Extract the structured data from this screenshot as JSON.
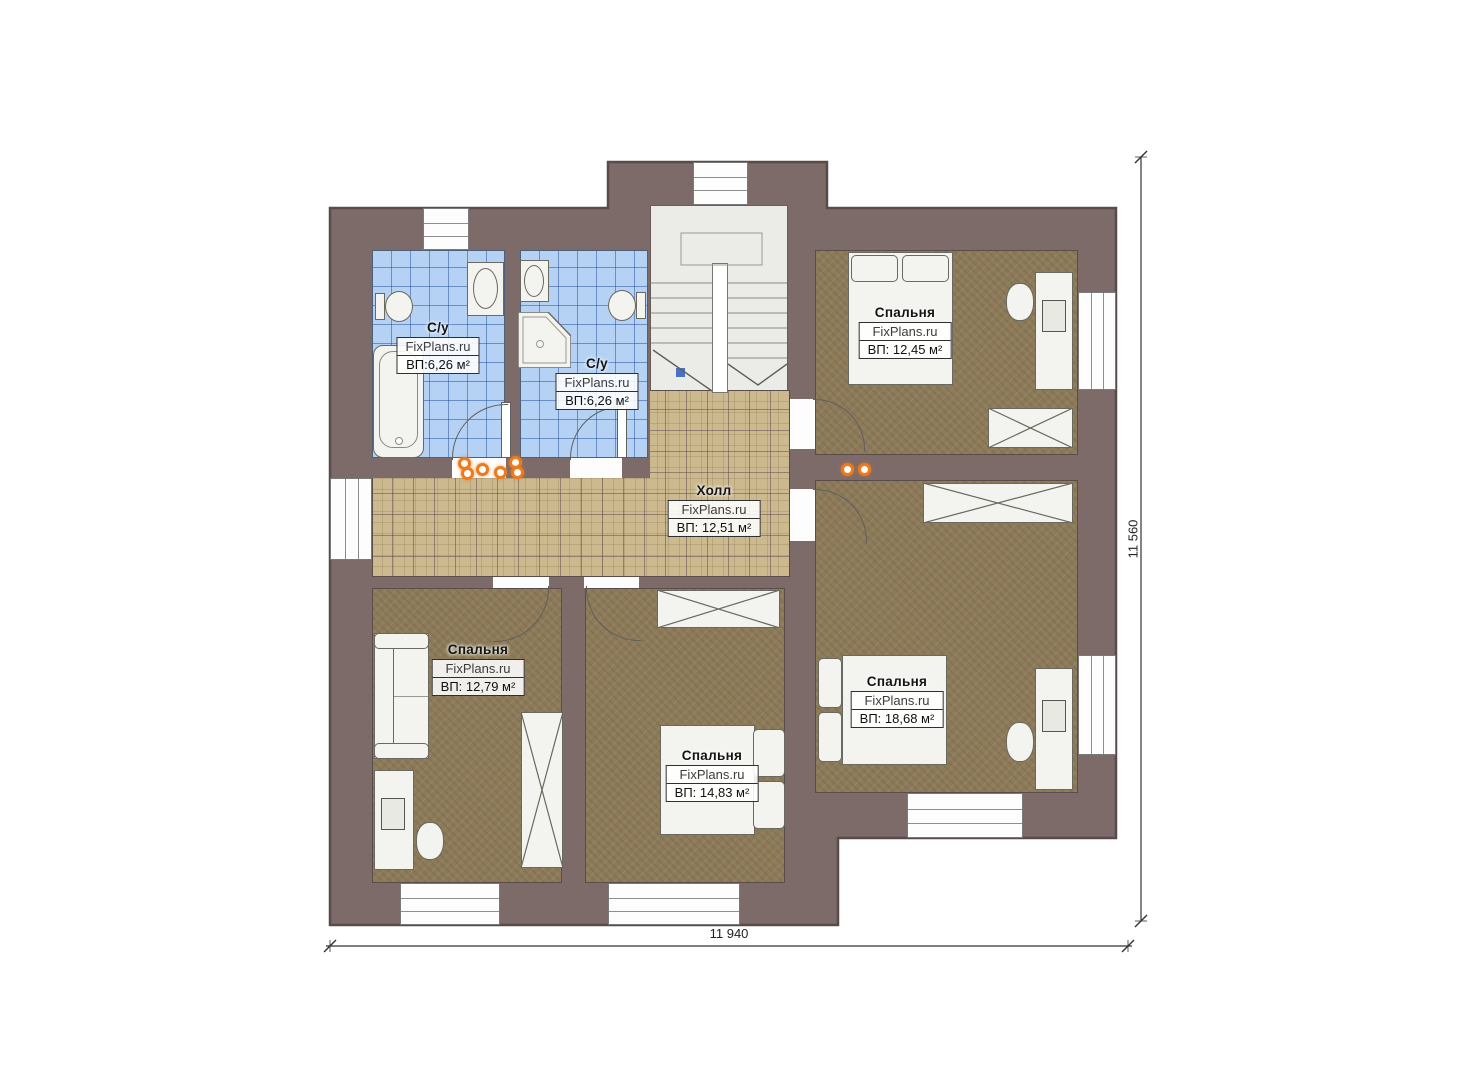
{
  "plan": {
    "rooms": {
      "bath_left": {
        "label": "С/у",
        "brand": "FixPlans.ru",
        "area": "ВП:6,26 м²"
      },
      "bath_right": {
        "label": "С/у",
        "brand": "FixPlans.ru",
        "area": "ВП:6,26 м²"
      },
      "hall": {
        "label": "Холл",
        "brand": "FixPlans.ru",
        "area": "ВП: 12,51 м²"
      },
      "bedroom_top_right": {
        "label": "Спальня",
        "brand": "FixPlans.ru",
        "area": "ВП: 12,45 м²"
      },
      "bedroom_right": {
        "label": "Спальня",
        "brand": "FixPlans.ru",
        "area": "ВП: 18,68 м²"
      },
      "bedroom_bottom_left": {
        "label": "Спальня",
        "brand": "FixPlans.ru",
        "area": "ВП: 12,79 м²"
      },
      "bedroom_bottom_middle": {
        "label": "Спальня",
        "brand": "FixPlans.ru",
        "area": "ВП: 14,83 м²"
      }
    },
    "dimensions": {
      "width_label": "11 940",
      "height_label": "11 560"
    },
    "colors": {
      "wall": "#7d6b6a",
      "wall_outline": "#594b4a",
      "bathroom_floor": "#b5d2f4",
      "hall_floor": "#ccb98e",
      "bedroom_floor": "#8c7a58",
      "stair_floor": "#ebebe8",
      "accent_orange": "#ee7a1c",
      "dimension_line": "#333333"
    }
  }
}
